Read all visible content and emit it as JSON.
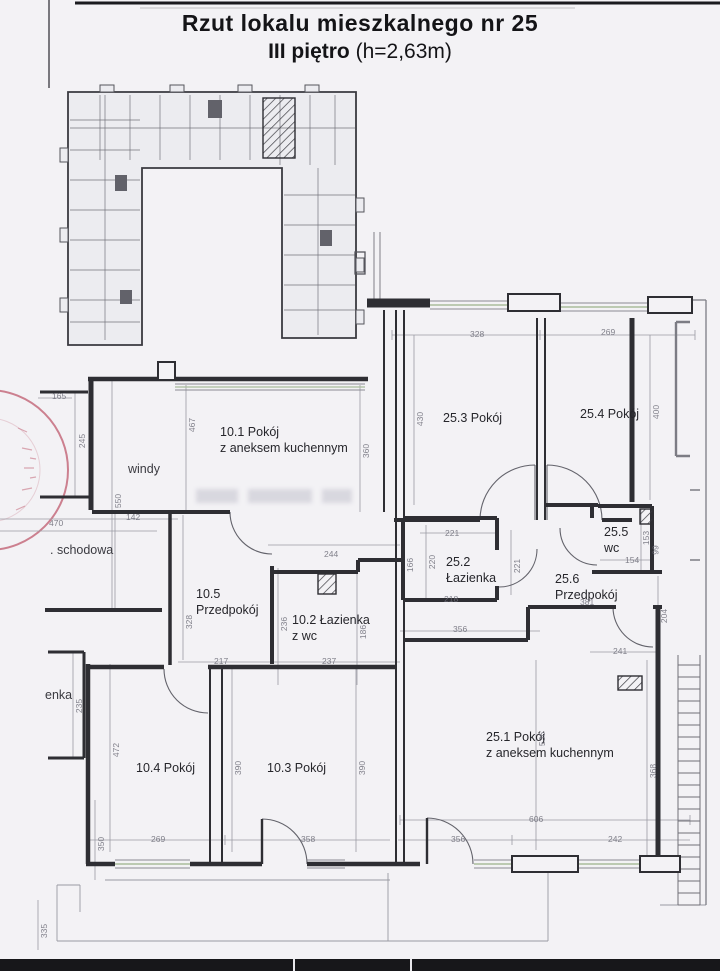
{
  "title": {
    "line1": "Rzut lokalu mieszkalnego nr 25",
    "line2_bold": "III piętro",
    "line2_rest": " (h=2,63m)"
  },
  "colors": {
    "paper": "#f3f2f5",
    "wall": "#2e2e33",
    "dim_line": "#9a9aa4",
    "window_green": "#a9bd9c",
    "stamp_red": "#bf5a6e"
  },
  "plan": {
    "room_labels": [
      {
        "lines": [
          "10.1 Pokój",
          "z aneksem kuchennym"
        ],
        "x": 220,
        "y": 424
      },
      {
        "lines": [
          "25.3 Pokój"
        ],
        "x": 443,
        "y": 410
      },
      {
        "lines": [
          "25.4 Pokój"
        ],
        "x": 580,
        "y": 406
      },
      {
        "lines": [
          "25.2",
          "Łazienka"
        ],
        "x": 446,
        "y": 554
      },
      {
        "lines": [
          "25.5",
          "wc"
        ],
        "x": 604,
        "y": 524
      },
      {
        "lines": [
          "25.6",
          "Przedpokój"
        ],
        "x": 555,
        "y": 571
      },
      {
        "lines": [
          "10.5",
          "Przedpokój"
        ],
        "x": 196,
        "y": 586
      },
      {
        "lines": [
          "10.2 Łazienka",
          "z wc"
        ],
        "x": 292,
        "y": 612
      },
      {
        "lines": [
          "25.1 Pokój",
          "z aneksem kuchennym"
        ],
        "x": 486,
        "y": 729
      },
      {
        "lines": [
          "10.4 Pokój"
        ],
        "x": 136,
        "y": 760
      },
      {
        "lines": [
          "10.3 Pokój"
        ],
        "x": 267,
        "y": 760
      }
    ],
    "area_labels": [
      {
        "text": "windy",
        "x": 128,
        "y": 462
      },
      {
        "text": ". schodowa",
        "x": 50,
        "y": 543
      },
      {
        "text": "enka",
        "x": 45,
        "y": 688
      }
    ],
    "dimensions": [
      {
        "t": "328",
        "x": 470,
        "y": 329,
        "r": 0
      },
      {
        "t": "269",
        "x": 601,
        "y": 327,
        "r": 0
      },
      {
        "t": "430",
        "x": 413,
        "y": 414,
        "r": -90
      },
      {
        "t": "400",
        "x": 649,
        "y": 407,
        "r": -90
      },
      {
        "t": "467",
        "x": 185,
        "y": 420,
        "r": -90
      },
      {
        "t": "360",
        "x": 359,
        "y": 446,
        "r": -90
      },
      {
        "t": "165",
        "x": 52,
        "y": 391,
        "r": 0
      },
      {
        "t": "245",
        "x": 75,
        "y": 436,
        "r": -90
      },
      {
        "t": "550",
        "x": 111,
        "y": 496,
        "r": -90
      },
      {
        "t": "142",
        "x": 126,
        "y": 512,
        "r": 0
      },
      {
        "t": "470",
        "x": 49,
        "y": 518,
        "r": 0
      },
      {
        "t": "244",
        "x": 324,
        "y": 549,
        "r": 0
      },
      {
        "t": "221",
        "x": 445,
        "y": 528,
        "r": 0
      },
      {
        "t": "166",
        "x": 403,
        "y": 560,
        "r": -90
      },
      {
        "t": "220",
        "x": 425,
        "y": 557,
        "r": -90
      },
      {
        "t": "221",
        "x": 510,
        "y": 561,
        "r": -90
      },
      {
        "t": "153",
        "x": 639,
        "y": 533,
        "r": -90
      },
      {
        "t": "99",
        "x": 651,
        "y": 545,
        "r": -90
      },
      {
        "t": "154",
        "x": 625,
        "y": 555,
        "r": 0
      },
      {
        "t": "218",
        "x": 444,
        "y": 594,
        "r": 0
      },
      {
        "t": "381",
        "x": 580,
        "y": 597,
        "r": 0
      },
      {
        "t": "356",
        "x": 453,
        "y": 624,
        "r": 0
      },
      {
        "t": "204",
        "x": 657,
        "y": 611,
        "r": -90
      },
      {
        "t": "241",
        "x": 613,
        "y": 646,
        "r": 0
      },
      {
        "t": "236",
        "x": 277,
        "y": 619,
        "r": -90
      },
      {
        "t": "186",
        "x": 356,
        "y": 627,
        "r": -90
      },
      {
        "t": "328",
        "x": 182,
        "y": 617,
        "r": -90
      },
      {
        "t": "217",
        "x": 214,
        "y": 656,
        "r": 0
      },
      {
        "t": "237",
        "x": 322,
        "y": 656,
        "r": 0
      },
      {
        "t": "235",
        "x": 72,
        "y": 701,
        "r": -90
      },
      {
        "t": "472",
        "x": 109,
        "y": 745,
        "r": -90
      },
      {
        "t": "390",
        "x": 231,
        "y": 763,
        "r": -90
      },
      {
        "t": "390",
        "x": 355,
        "y": 763,
        "r": -90
      },
      {
        "t": "536",
        "x": 535,
        "y": 734,
        "r": -90
      },
      {
        "t": "368",
        "x": 646,
        "y": 766,
        "r": -90
      },
      {
        "t": "269",
        "x": 151,
        "y": 834,
        "r": 0
      },
      {
        "t": "358",
        "x": 301,
        "y": 834,
        "r": 0
      },
      {
        "t": "606",
        "x": 529,
        "y": 814,
        "r": 0
      },
      {
        "t": "356",
        "x": 451,
        "y": 834,
        "r": 0
      },
      {
        "t": "242",
        "x": 608,
        "y": 834,
        "r": 0
      },
      {
        "t": "350",
        "x": 94,
        "y": 839,
        "r": -90
      },
      {
        "t": "335",
        "x": 37,
        "y": 926,
        "r": -90
      }
    ]
  }
}
